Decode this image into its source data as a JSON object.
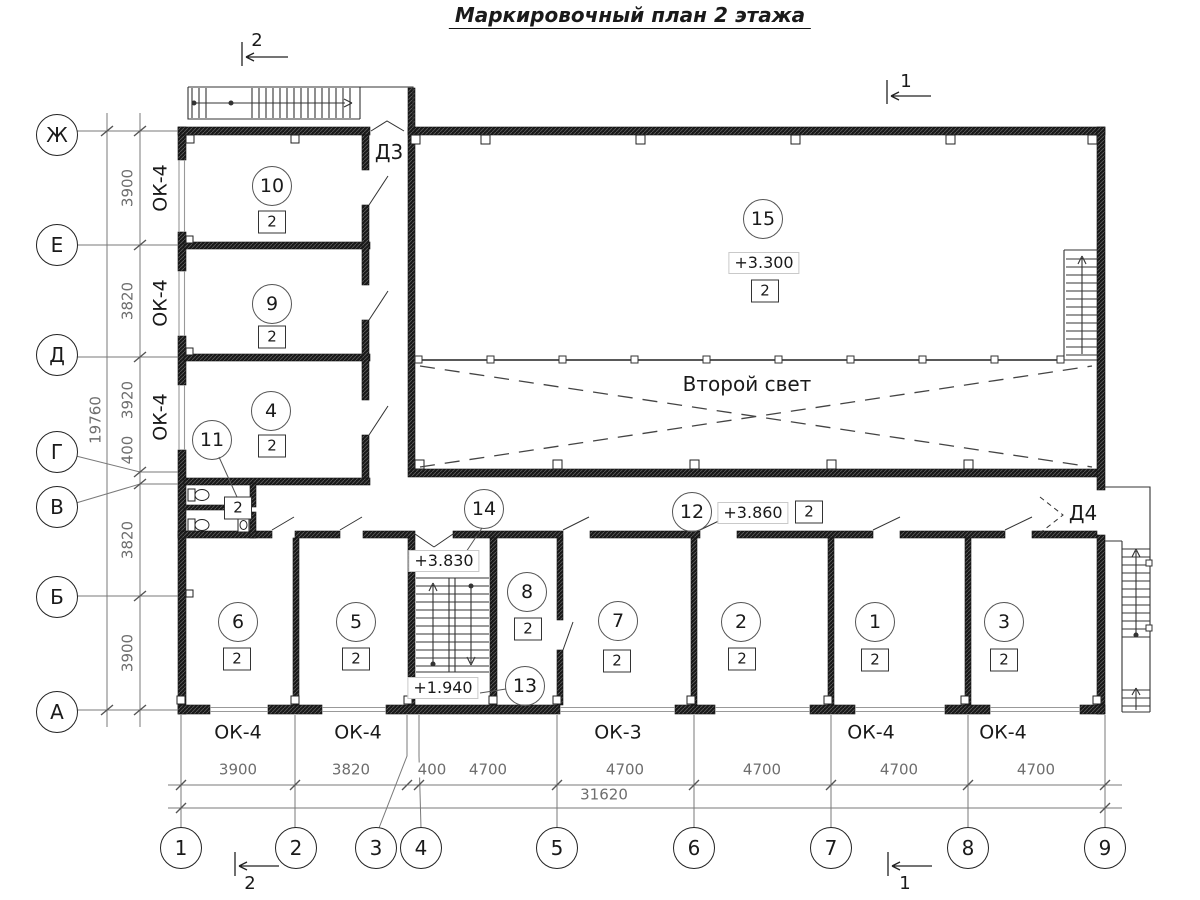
{
  "title": "Маркировочный план 2 этажа",
  "labels": {
    "row_axes": [
      {
        "t": "Ж",
        "x": 57,
        "y": 135
      },
      {
        "t": "Е",
        "x": 57,
        "y": 245
      },
      {
        "t": "Д",
        "x": 57,
        "y": 355
      },
      {
        "t": "Г",
        "x": 57,
        "y": 452
      },
      {
        "t": "В",
        "x": 57,
        "y": 507
      },
      {
        "t": "Б",
        "x": 57,
        "y": 597
      },
      {
        "t": "А",
        "x": 57,
        "y": 712
      }
    ],
    "col_axes": [
      {
        "t": "1",
        "x": 181,
        "y": 848
      },
      {
        "t": "2",
        "x": 296,
        "y": 848
      },
      {
        "t": "3",
        "x": 376,
        "y": 848
      },
      {
        "t": "4",
        "x": 421,
        "y": 848
      },
      {
        "t": "5",
        "x": 557,
        "y": 848
      },
      {
        "t": "6",
        "x": 694,
        "y": 848
      },
      {
        "t": "7",
        "x": 831,
        "y": 848
      },
      {
        "t": "8",
        "x": 968,
        "y": 848
      },
      {
        "t": "9",
        "x": 1105,
        "y": 848
      }
    ],
    "dims_v": [
      {
        "t": "3900",
        "x": 128,
        "y": 188
      },
      {
        "t": "3820",
        "x": 128,
        "y": 301
      },
      {
        "t": "3920",
        "x": 128,
        "y": 400
      },
      {
        "t": "400",
        "x": 128,
        "y": 450
      },
      {
        "t": "3820",
        "x": 128,
        "y": 540
      },
      {
        "t": "3900",
        "x": 128,
        "y": 653
      },
      {
        "t": "19760",
        "x": 96,
        "y": 420
      }
    ],
    "dims_h": [
      {
        "t": "3900",
        "x": 238,
        "y": 770
      },
      {
        "t": "3820",
        "x": 351,
        "y": 770
      },
      {
        "t": "400",
        "x": 432,
        "y": 770
      },
      {
        "t": "4700",
        "x": 488,
        "y": 770
      },
      {
        "t": "4700",
        "x": 625,
        "y": 770
      },
      {
        "t": "4700",
        "x": 762,
        "y": 770
      },
      {
        "t": "4700",
        "x": 899,
        "y": 770
      },
      {
        "t": "4700",
        "x": 1036,
        "y": 770
      },
      {
        "t": "31620",
        "x": 604,
        "y": 795
      }
    ],
    "rooms": [
      {
        "n": "10",
        "x": 272,
        "y": 186,
        "sq": "2",
        "sx": 272,
        "sy": 222
      },
      {
        "n": "9",
        "x": 272,
        "y": 304,
        "sq": "2",
        "sx": 272,
        "sy": 337
      },
      {
        "n": "4",
        "x": 271,
        "y": 411,
        "sq": "2",
        "sx": 272,
        "sy": 446
      },
      {
        "n": "11",
        "x": 212,
        "y": 440,
        "sq": "2",
        "sx": 238,
        "sy": 508
      },
      {
        "n": "15",
        "x": 763,
        "y": 219,
        "sq": "2",
        "sx": 765,
        "sy": 291
      },
      {
        "n": "12",
        "x": 692,
        "y": 512,
        "sq": "2",
        "sx": 809,
        "sy": 512
      },
      {
        "n": "14",
        "x": 484,
        "y": 509
      },
      {
        "n": "13",
        "x": 525,
        "y": 686
      },
      {
        "n": "6",
        "x": 238,
        "y": 622,
        "sq": "2",
        "sx": 237,
        "sy": 659
      },
      {
        "n": "5",
        "x": 356,
        "y": 622,
        "sq": "2",
        "sx": 356,
        "sy": 659
      },
      {
        "n": "8",
        "x": 527,
        "y": 592,
        "sq": "2",
        "sx": 528,
        "sy": 629
      },
      {
        "n": "7",
        "x": 618,
        "y": 621,
        "sq": "2",
        "sx": 617,
        "sy": 661
      },
      {
        "n": "2",
        "x": 741,
        "y": 622,
        "sq": "2",
        "sx": 742,
        "sy": 659
      },
      {
        "n": "1",
        "x": 875,
        "y": 622,
        "sq": "2",
        "sx": 875,
        "sy": 660
      },
      {
        "n": "3",
        "x": 1004,
        "y": 622,
        "sq": "2",
        "sx": 1004,
        "sy": 660
      }
    ],
    "levels": [
      {
        "t": "+3.300",
        "x": 764,
        "y": 263
      },
      {
        "t": "+3.860",
        "x": 753,
        "y": 513
      },
      {
        "t": "+3.830",
        "x": 444,
        "y": 561
      },
      {
        "t": "+1.940",
        "x": 443,
        "y": 688
      }
    ],
    "windows": [
      {
        "t": "ОК-4",
        "x": 161,
        "y": 188,
        "rot": true
      },
      {
        "t": "ОК-4",
        "x": 161,
        "y": 303,
        "rot": true
      },
      {
        "t": "ОК-4",
        "x": 161,
        "y": 417,
        "rot": true
      },
      {
        "t": "ОК-4",
        "x": 238,
        "y": 733
      },
      {
        "t": "ОК-4",
        "x": 358,
        "y": 733
      },
      {
        "t": "ОК-3",
        "x": 618,
        "y": 733
      },
      {
        "t": "ОК-4",
        "x": 871,
        "y": 733
      },
      {
        "t": "ОК-4",
        "x": 1003,
        "y": 733
      }
    ],
    "doors": [
      {
        "t": "Д3",
        "x": 389,
        "y": 152
      },
      {
        "t": "Д4",
        "x": 1083,
        "y": 513
      }
    ],
    "atrium": {
      "t": "Второй свет",
      "x": 747,
      "y": 384
    },
    "sections": [
      {
        "t": "2",
        "x": 257,
        "y": 41
      },
      {
        "t": "1",
        "x": 906,
        "y": 82
      },
      {
        "t": "2",
        "x": 250,
        "y": 884
      },
      {
        "t": "1",
        "x": 905,
        "y": 884
      }
    ]
  }
}
